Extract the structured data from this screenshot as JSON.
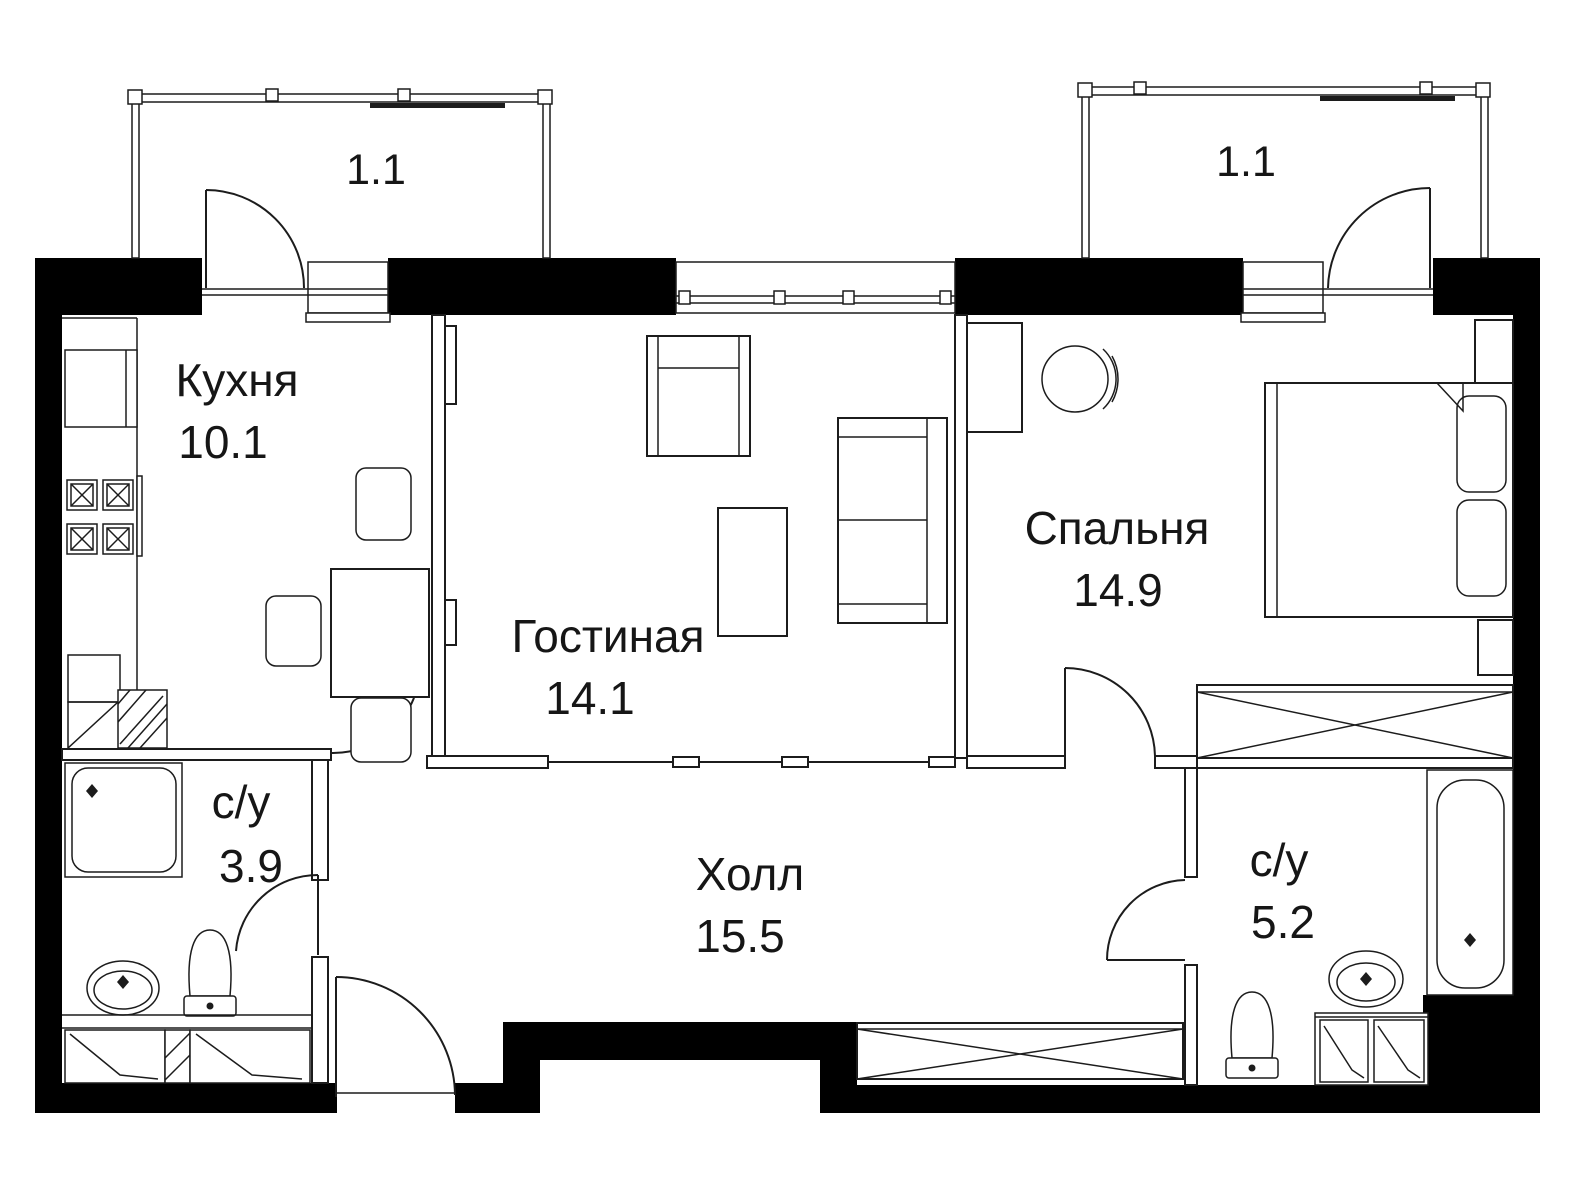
{
  "plan": {
    "colors": {
      "wall": "#000000",
      "line": "#1c1c1c",
      "bg": "#ffffff"
    },
    "rooms": [
      {
        "id": "kitchen",
        "name": "Кухня",
        "area": "10.1"
      },
      {
        "id": "living",
        "name": "Гостиная",
        "area": "14.1"
      },
      {
        "id": "bedroom",
        "name": "Спальня",
        "area": "14.9"
      },
      {
        "id": "hall",
        "name": "Холл",
        "area": "15.5"
      },
      {
        "id": "bath-small",
        "name": "с/у",
        "area": "3.9"
      },
      {
        "id": "bath-big",
        "name": "с/у",
        "area": "5.2"
      }
    ],
    "balconies": [
      {
        "id": "balcony-left",
        "area": "1.1"
      },
      {
        "id": "balcony-right",
        "area": "1.1"
      }
    ]
  }
}
